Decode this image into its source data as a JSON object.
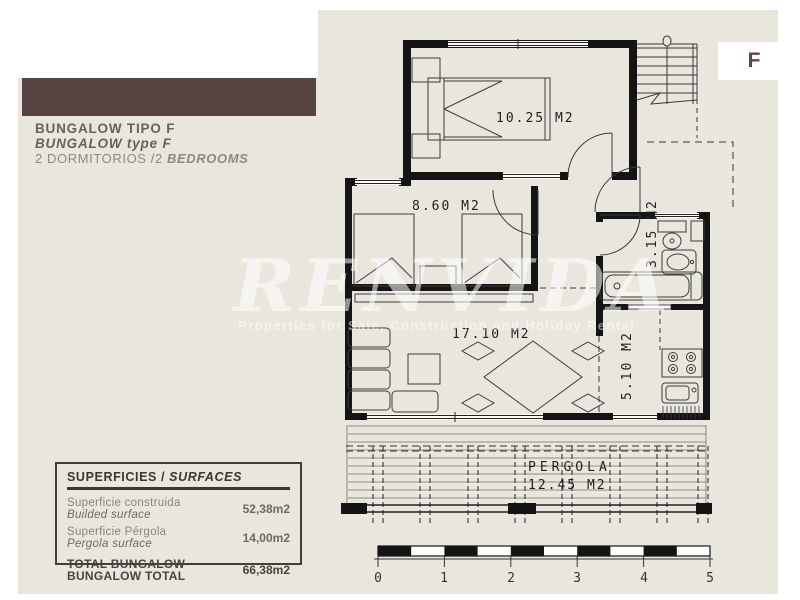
{
  "header": {
    "title": "BUNGALOW TIPO F",
    "subtitle": "BUNGALOW type F",
    "rooms_prefix": "2 DORMITORIOS /2 ",
    "rooms_italic": "BEDROOMS"
  },
  "badge": {
    "letter": "F"
  },
  "watermark": {
    "brand": "RENVIDA",
    "tagline": "Properties for Sale, Construction and Holiday Rental"
  },
  "plan": {
    "labels": {
      "bedroom1": "10.25 M2",
      "bedroom2": "8.60 M2",
      "bathroom": "3.15 M2",
      "living": "17.10 M2",
      "kitchen": "5.10 M2",
      "pergola_name": "PERGOLA",
      "pergola_area": "12.45 M2"
    }
  },
  "surfaces_table": {
    "title_es": "SUPERFICIES / ",
    "title_en": "SURFACES",
    "rows": [
      {
        "label_es": "Superficie construida",
        "label_en": "Builded surface",
        "value": "52,38m2"
      },
      {
        "label_es": "Superficie Pérgola",
        "label_en": "Pergola surface",
        "value": "14,00m2"
      }
    ],
    "total": {
      "label_es": "TOTAL BUNGALOW",
      "label_en": "BUNGALOW TOTAL",
      "value": "66,38m2"
    }
  },
  "scale": {
    "ticks": [
      "0",
      "1",
      "2",
      "3",
      "4",
      "5"
    ]
  },
  "colors": {
    "brand_brown": "#574442",
    "sheet_beige": "#e9e7dd",
    "wall_black": "#141414"
  }
}
